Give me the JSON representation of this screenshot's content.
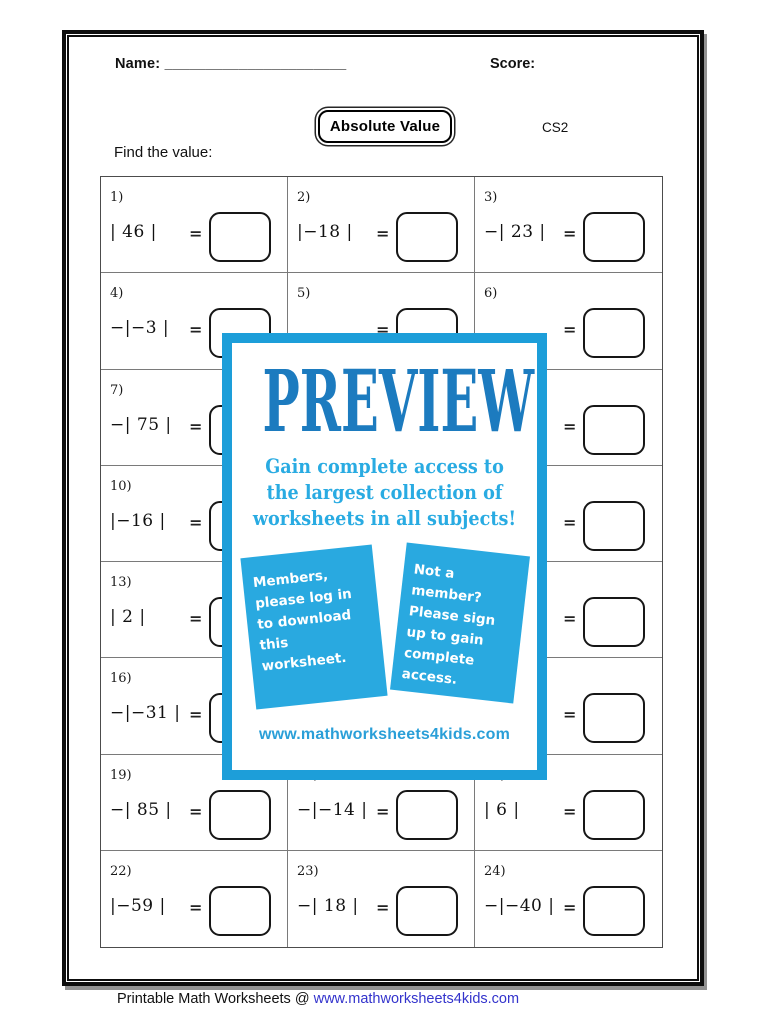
{
  "header": {
    "name_label": "Name:",
    "name_line": "______________________",
    "score_label": "Score:",
    "title": "Absolute Value",
    "code": "CS2",
    "instruction": "Find the value:"
  },
  "grid": {
    "equals_sign": "=",
    "problems": [
      {
        "label": "1)",
        "expr": "| 46 |"
      },
      {
        "label": "2)",
        "expr": "|−18 |"
      },
      {
        "label": "3)",
        "expr": "−| 23 |"
      },
      {
        "label": "4)",
        "expr": "−|−3 |"
      },
      {
        "label": "5)",
        "expr": ""
      },
      {
        "label": "6)",
        "expr": ""
      },
      {
        "label": "7)",
        "expr": "−| 75 |"
      },
      {
        "label": "",
        "expr": ""
      },
      {
        "label": "",
        "expr": ""
      },
      {
        "label": "10)",
        "expr": "|−16 |"
      },
      {
        "label": "",
        "expr": ""
      },
      {
        "label": "",
        "expr": ""
      },
      {
        "label": "13)",
        "expr": "| 2 |"
      },
      {
        "label": "",
        "expr": ""
      },
      {
        "label": "",
        "expr": ""
      },
      {
        "label": "16)",
        "expr": "−|−31 |"
      },
      {
        "label": "",
        "expr": ""
      },
      {
        "label": "",
        "expr": ""
      },
      {
        "label": "19)",
        "expr": "−| 85 |"
      },
      {
        "label": "20)",
        "expr": "−|−14 |"
      },
      {
        "label": "21)",
        "expr": "| 6 |"
      },
      {
        "label": "22)",
        "expr": "|−59 |"
      },
      {
        "label": "23)",
        "expr": "−| 18 |"
      },
      {
        "label": "24)",
        "expr": "−|−40 |"
      }
    ]
  },
  "overlay": {
    "preview_word": "PREVIEW",
    "tagline": "Gain complete access to the largest collection of worksheets in all subjects!",
    "member_note": "Members, please log in to download this worksheet.",
    "nonmember_note": "Not a member? Please sign up to gain complete access.",
    "website": "www.mathworksheets4kids.com",
    "frame_color": "#1d9ed9",
    "preview_color": "#1c7bbf",
    "accent_color": "#29abe2"
  },
  "footer": {
    "text": "Printable Math Worksheets @ ",
    "link": "www.mathworksheets4kids.com",
    "link_color": "#3333cc"
  }
}
